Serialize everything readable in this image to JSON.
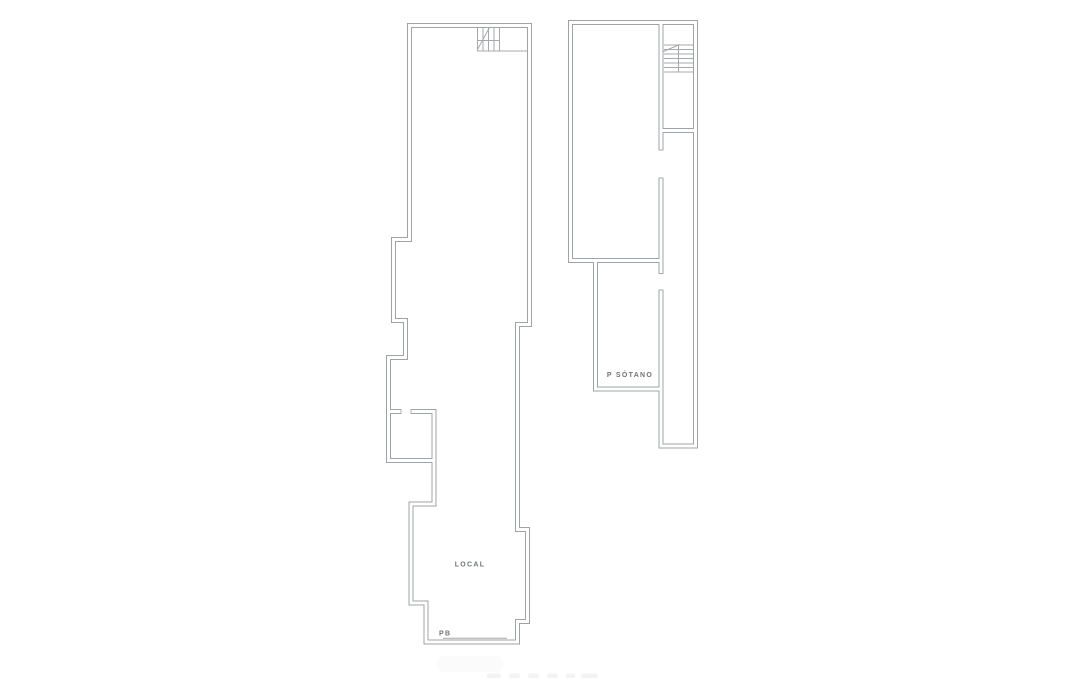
{
  "page": {
    "background": "#ffffff"
  },
  "colors": {
    "wall": "#9fa3a6",
    "thin": "#a6a9ac",
    "text": "#6f7477",
    "watermark_blob": "#fbfbfb",
    "watermark_dashes": "#f3f3f3"
  },
  "plans": {
    "pb": {
      "space_label": "LOCAL",
      "floor_label": "PB"
    },
    "sotano": {
      "floor_label": "P SÓTANO"
    }
  }
}
